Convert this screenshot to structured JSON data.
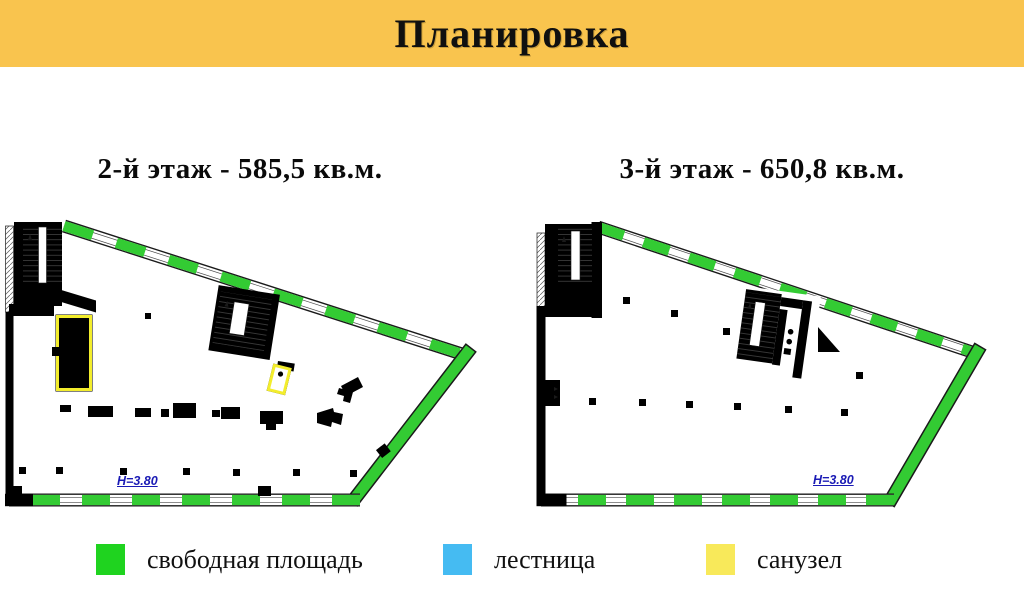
{
  "header": {
    "title": "Планировка"
  },
  "plans": [
    {
      "title": "2-й этаж - 585,5 кв.м.",
      "height_label": "Н=3.80"
    },
    {
      "title": "3-й этаж - 650,8 кв.м.",
      "height_label": "Н=3.80"
    }
  ],
  "legend": {
    "items": [
      {
        "name": "free-area",
        "label": "свободная площадь",
        "color": "#1fd31f"
      },
      {
        "name": "staircase",
        "label": "лестница",
        "color": "#45bbf2"
      },
      {
        "name": "bathroom",
        "label": "санузел",
        "color": "#f8e95a"
      }
    ]
  },
  "colors": {
    "header_bg": "#f9c44e",
    "plan_green": "#33cb33",
    "plan_yellow": "#f3ed2c",
    "stair_blue": "#cfe4f1",
    "annotation_blue": "#1a1ab5",
    "wall_ink": "#1a1a1a"
  }
}
